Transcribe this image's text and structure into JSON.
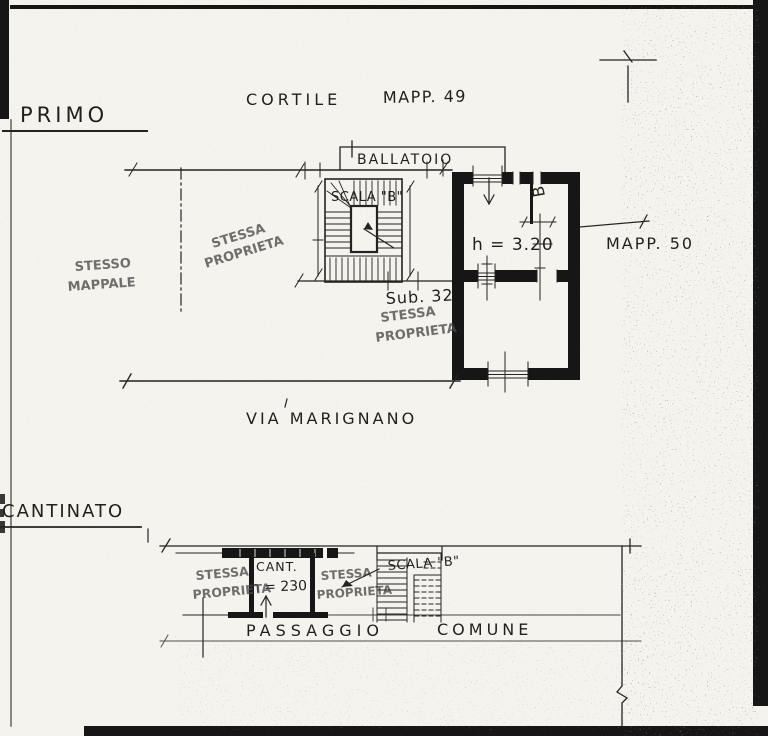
{
  "colors": {
    "paper": "#f4f3ee",
    "ink": "#232323",
    "stamp": "#4a4a4a"
  },
  "primo": {
    "title": "PRIMO",
    "cortile": "CORTILE",
    "mapp_49": "MAPP. 49",
    "ballatoio": "BALLATOIO",
    "scala_b": "SCALA \"B\"",
    "room_height": "h = 3.20",
    "bath_label": "B",
    "mapp_50": "MAPP. 50",
    "sub": "Sub. 32",
    "street": "VIA MARIGNANO",
    "stamp_mappale": [
      "STESSO",
      "MAPPALE"
    ],
    "stamp_prop_left": [
      "STESSA",
      "PROPRIETA"
    ],
    "stamp_prop_sub": [
      "STESSA",
      "PROPRIETA"
    ]
  },
  "cantinato": {
    "title": "CANTINATO",
    "cant": "CANT.",
    "cant_height": "h = 230",
    "scala_b": "SCALA \"B\"",
    "passaggio": "PASSAGGIO",
    "comune": "COMUNE",
    "stamp_prop_left": [
      "STESSA",
      "PROPRIETA"
    ],
    "stamp_prop_right": [
      "STESSA",
      "PROPRIETA"
    ]
  }
}
